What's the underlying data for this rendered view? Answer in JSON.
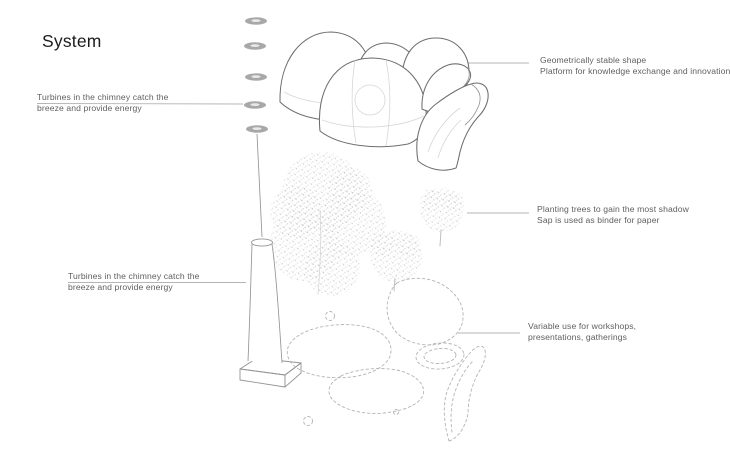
{
  "title": "System",
  "annotations": {
    "turbines_top": {
      "line1": "Turbines in the chimney catch the",
      "line2": "breeze and provide energy"
    },
    "geometry": {
      "line1": "Geometrically stable shape",
      "line2": "Platform for knowledge exchange and innovation"
    },
    "planting": {
      "line1": "Planting trees to gain the most shadow",
      "line2": "Sap is used as binder for paper"
    },
    "turbines_bottom": {
      "line1": "Turbines in the chimney catch the",
      "line2": "breeze and provide energy"
    },
    "variable_use": {
      "line1": "Variable use for workshops,",
      "line2": "presentations, gatherings"
    }
  },
  "diagram": {
    "elements": [
      {
        "name": "turbine-disks",
        "links_to": "turbines_top"
      },
      {
        "name": "chimney",
        "links_to": "turbines_bottom"
      },
      {
        "name": "dome-cluster",
        "links_to": "geometry"
      },
      {
        "name": "trees",
        "links_to": "planting"
      },
      {
        "name": "dashed-footprint",
        "links_to": "variable_use"
      }
    ]
  },
  "colors": {
    "background": "#ffffff",
    "title-ink": "#1c1c1c",
    "label-text": "#5f5f5f",
    "sketch-stroke": "#6e6e6e",
    "light-stroke": "#949494",
    "faint-stroke": "#d6d6d6",
    "dashed-stroke": "#b4b4b4",
    "tree-dot": "#cfcfcf",
    "leader-line": "#b5b5b5",
    "disk-fill": "#a8a8a8"
  }
}
